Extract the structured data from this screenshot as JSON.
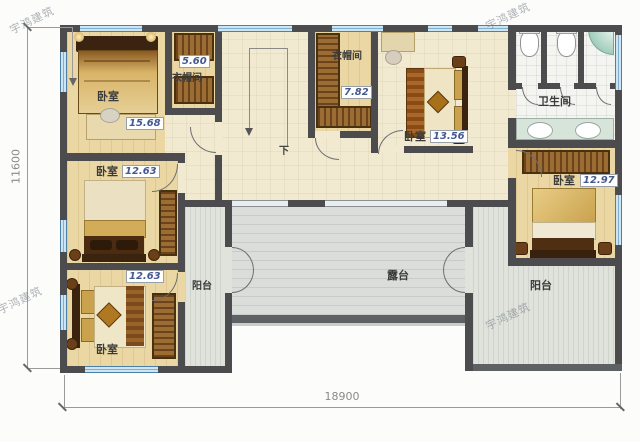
{
  "plan": {
    "watermark": "宇鸿建筑",
    "stair": {
      "down_label": "下"
    },
    "dimensions": {
      "overall_width": "18900",
      "overall_height": "11600"
    },
    "rooms": {
      "bedroom_top_left": {
        "label": "卧室",
        "area": "15.68"
      },
      "closet_top_left": {
        "label": "衣帽间",
        "area": "5.60"
      },
      "closet_center": {
        "label": "衣帽间",
        "area": "7.82"
      },
      "bedroom_center": {
        "label": "卧室",
        "area": "13.56"
      },
      "bathroom": {
        "label": "卫生间"
      },
      "bedroom_right": {
        "label": "卧室",
        "area": "12.97"
      },
      "bedroom_mid_left": {
        "label": "卧室",
        "area": "12.63"
      },
      "bedroom_bottom_left": {
        "label": "卧室",
        "area": "12.63"
      },
      "balcony_left": {
        "label": "阳台"
      },
      "balcony_right": {
        "label": "阳台"
      },
      "terrace": {
        "label": "露台"
      }
    },
    "colors": {
      "wall": "#4c4c4e",
      "window_frame": "#4b81a8",
      "wood_floor": "#ead7a4",
      "hall_floor": "#f1ead0",
      "terrace_floor": "#dadddA",
      "balcony_floor": "#e0e3dc",
      "area_text": "#44598f"
    }
  }
}
